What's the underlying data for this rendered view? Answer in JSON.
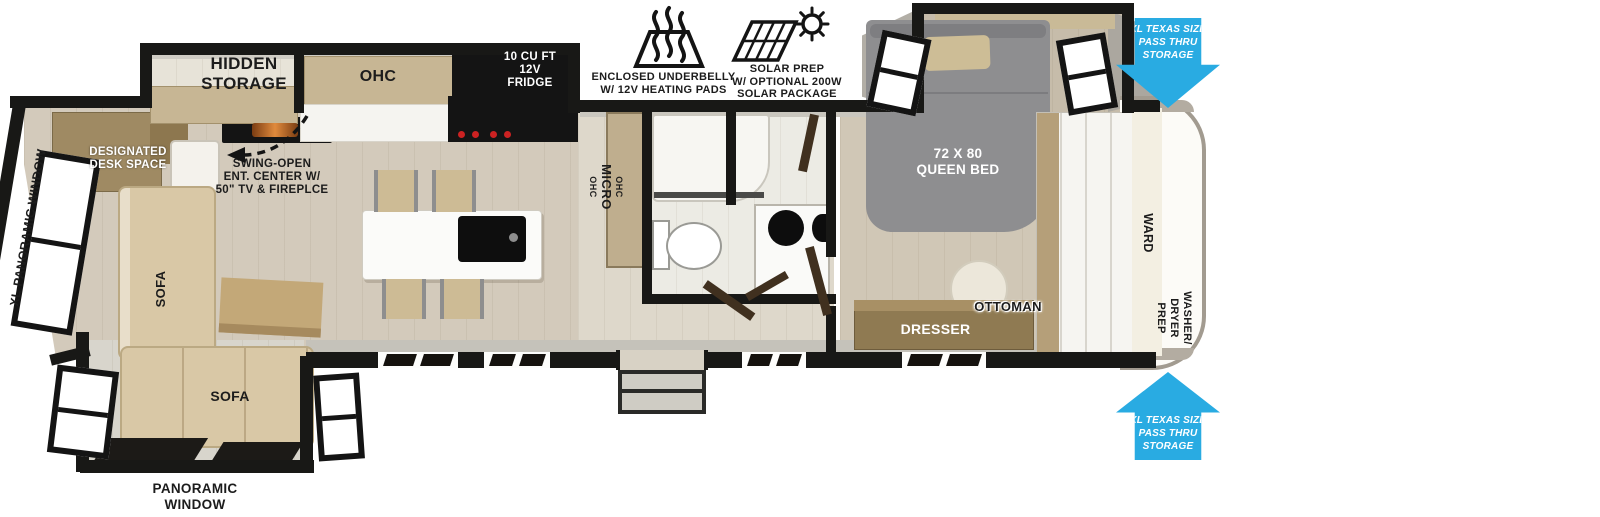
{
  "labels": {
    "hidden_storage": "HIDDEN\nSTORAGE",
    "ohc": "OHC",
    "fridge": "10 CU FT\n12V\nFRIDGE",
    "underbelly": "ENCLOSED UNDERBELLY\nW/ 12V HEATING PADS",
    "solar": "SOLAR PREP\nW/ OPTIONAL 200W\nSOLAR PACKAGE",
    "queen_bed": "72 X 80\nQUEEN BED",
    "pass_thru": "XL TEXAS SIZE\nPASS THRU\nSTORAGE",
    "xl_panoramic_window": "XL PANORAMIC WINDOW",
    "designated_desk": "DESIGNATED\nDESK SPACE",
    "swing_open": "SWING-OPEN\nENT. CENTER W/\n50\" TV & FIREPLCE",
    "sofa_left": "SOFA",
    "sofa_bottom": "SOFA",
    "panoramic_window": "PANORAMIC\nWINDOW",
    "cabinet_ohc_top": "OHC",
    "cabinet_micro": "MICRO",
    "cabinet_ohc_bottom": "OHC",
    "ottoman": "OTTOMAN",
    "dresser": "DRESSER",
    "ward": "WARD",
    "washer_dryer": "WASHER/\nDRYER\nPREP"
  },
  "colors": {
    "accent_blue": "#29ABE2",
    "wall_black": "#181816",
    "floor_wood": "#d3cabb",
    "floor_light": "#ded8cb",
    "floor_gray": "#d8d5cc",
    "cabinet_tan": "#c7b694",
    "sofa_tan": "#d9c8a6",
    "bed_gray": "#8e8e90",
    "desk_wood": "#9f8a63",
    "dresser_wood": "#8f7a52",
    "flame_orange": "#e08a3c"
  }
}
